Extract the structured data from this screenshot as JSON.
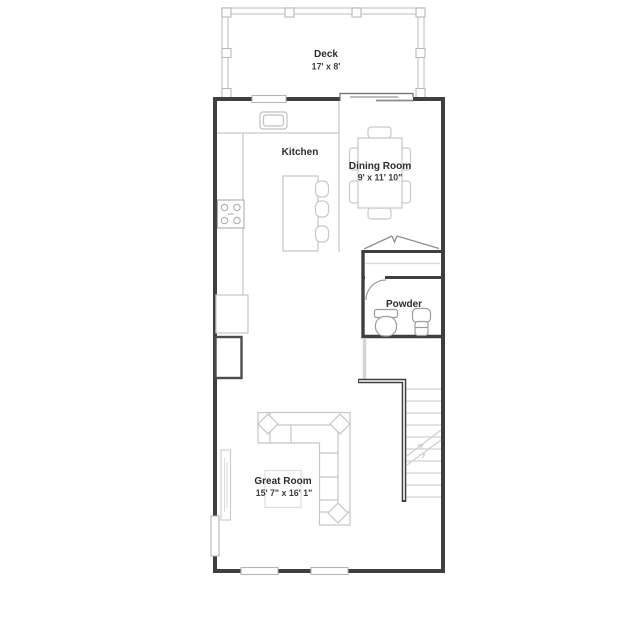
{
  "floorplan": {
    "title": "Floor plan",
    "rooms": {
      "deck": {
        "name": "Deck",
        "dims": "17' x 8'"
      },
      "kitchen": {
        "name": "Kitchen"
      },
      "dining": {
        "name": "Dining Room",
        "dims": "9' x 11' 10\""
      },
      "powder": {
        "name": "Powder"
      },
      "great": {
        "name": "Great Room",
        "dims": "15' 7\" x 16' 1\""
      }
    },
    "colors": {
      "wall": "#3f3f3f",
      "furniture": "#c9c9c9",
      "window_border": "#b5b5b5",
      "text": "#2e2b2c",
      "background": "#ffffff"
    }
  }
}
